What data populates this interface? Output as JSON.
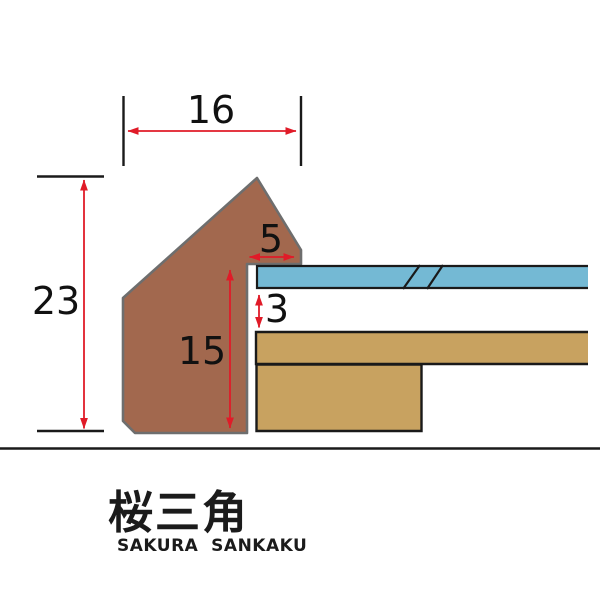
{
  "diagram": {
    "dimensions": {
      "top_width": "16",
      "left_height": "23",
      "lip_width": "5",
      "inner_depth": "15",
      "glass_gap": "3"
    },
    "colors": {
      "frame": "#a2684e",
      "frame_outline": "#6e6e6e",
      "glass": "#74b9d4",
      "board": "#c8a260",
      "dimension_arrow": "#e01b28",
      "line": "#1a1a1a"
    }
  },
  "footer": {
    "title_kanji": "桜三角",
    "title_romaji": "SAKURA  SANKAKU"
  }
}
